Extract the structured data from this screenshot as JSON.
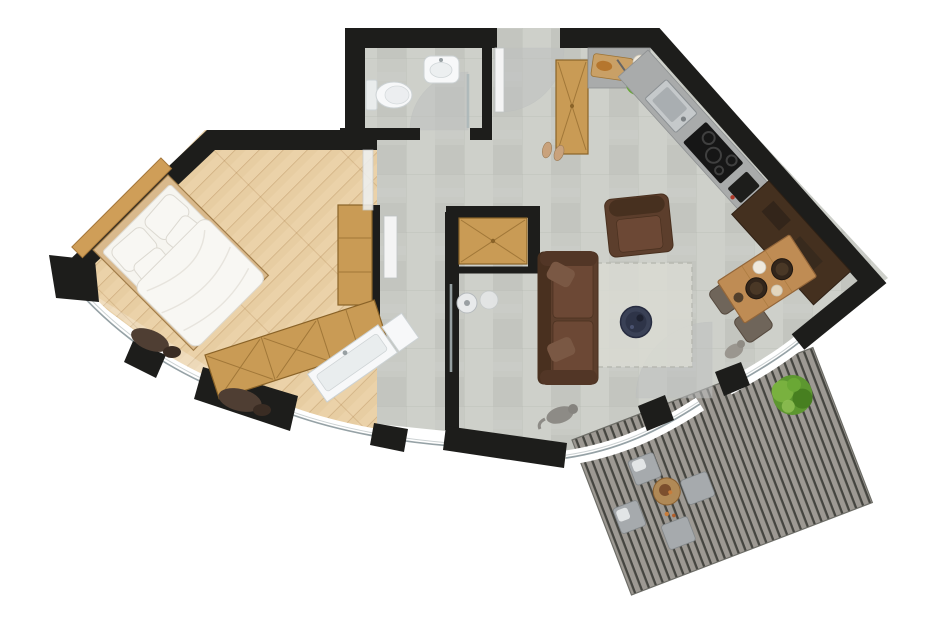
{
  "meta": {
    "kind": "architectural-floor-plan",
    "view": "top-down",
    "units": "pixels"
  },
  "canvas": {
    "width": 940,
    "height": 637,
    "background": "#ffffff"
  },
  "palette": {
    "wall": "#1d1d1b",
    "concreteBase": "#c8cac4",
    "concreteLight": "#d3d5cf",
    "concreteDark": "#bdbfb9",
    "woodFloor": "#ebd2a9",
    "woodLine": "rgba(166,122,70,0.40)",
    "wardrobe": "#c99b55",
    "wardrobeEdge": "#8a6328",
    "wardrobeLine": "#9c7335",
    "bedWood": "#d9b98c",
    "bedding": "#f8f7f3",
    "beddingEdge": "#dcd9d1",
    "counter": "#a9abab",
    "counterEdge": "#8e9192",
    "sinkSteel": "#c5c9cb",
    "sinkInner": "#a9aeb1",
    "cooktop": "#161616",
    "sideboard": "#44301f",
    "sofa": "#5c3e2c",
    "sofaDark": "#49301f",
    "sofaCushion": "#6d4936",
    "rug": "#dadbd3",
    "rugEdge": "#b6b7af",
    "coffeeTable": "#3a4156",
    "coffeeTableDark": "#272c40",
    "diningTable": "#bf8c54",
    "diningEdge": "#93663a",
    "plate": "#33261b",
    "chair": "#6f655a",
    "chairEdge": "#55493e",
    "deckPlank": "#a29e98",
    "deckGap": "#454540",
    "deckEdge": "#6d6d67",
    "deckChair": "#a6aaad",
    "deckChairEdge": "#82878a",
    "deckTable": "#b08956",
    "plant": "#5d9730",
    "plantLight": "#79b13f",
    "plantDark": "#477f20",
    "windowBand": "#ffffff",
    "windowGlassLine": "#8b989c",
    "doorSwing": "#bec0c0",
    "doorLeaf": "#f4f4f4",
    "fixture": "#f7f8f9",
    "fixtureEdge": "#ccd2d4",
    "glass": "#aab6b8",
    "shoe": "#c9a27c",
    "cat": "#8d8b86",
    "clothes": "#4f3e33",
    "lettuce": "#69a838",
    "bread": "#b5762e",
    "board": "#c9a066",
    "bowl": "#efe9dd",
    "accentRed": "#b03a2a"
  },
  "rooms": {
    "bedroom": {
      "items": [
        "double-bed",
        "pillows",
        "duvet",
        "headboard-shelf",
        "l-shaped-wardrobe",
        "sliding-glass-door",
        "clothes-on-floor"
      ]
    },
    "bathroom": {
      "items": [
        "toilet",
        "washbasin",
        "corner-shower",
        "glass-shower-door"
      ]
    },
    "hallway": {
      "items": [
        "entrance-door",
        "tall-wardrobe",
        "shoes",
        "built-in-closet"
      ]
    },
    "shower_room": {
      "items": [
        "vanity-basin",
        "walk-in-shower",
        "glass-screen",
        "pocket-door"
      ]
    },
    "kitchen": {
      "items": [
        "gray-counter",
        "cutting-board",
        "salad",
        "bowl",
        "steel-sink",
        "induction-cooktop",
        "coffee-machine",
        "dark-sideboard"
      ]
    },
    "living_room": {
      "items": [
        "brown-sofa",
        "brown-armchair",
        "light-rug",
        "round-navy-coffee-table",
        "cat"
      ]
    },
    "dining": {
      "items": [
        "wooden-table",
        "set-plates",
        "two-chairs"
      ]
    },
    "terrace": {
      "items": [
        "plank-deck",
        "round-outdoor-table",
        "four-outdoor-chairs",
        "green-plant",
        "terrace-door"
      ]
    }
  }
}
